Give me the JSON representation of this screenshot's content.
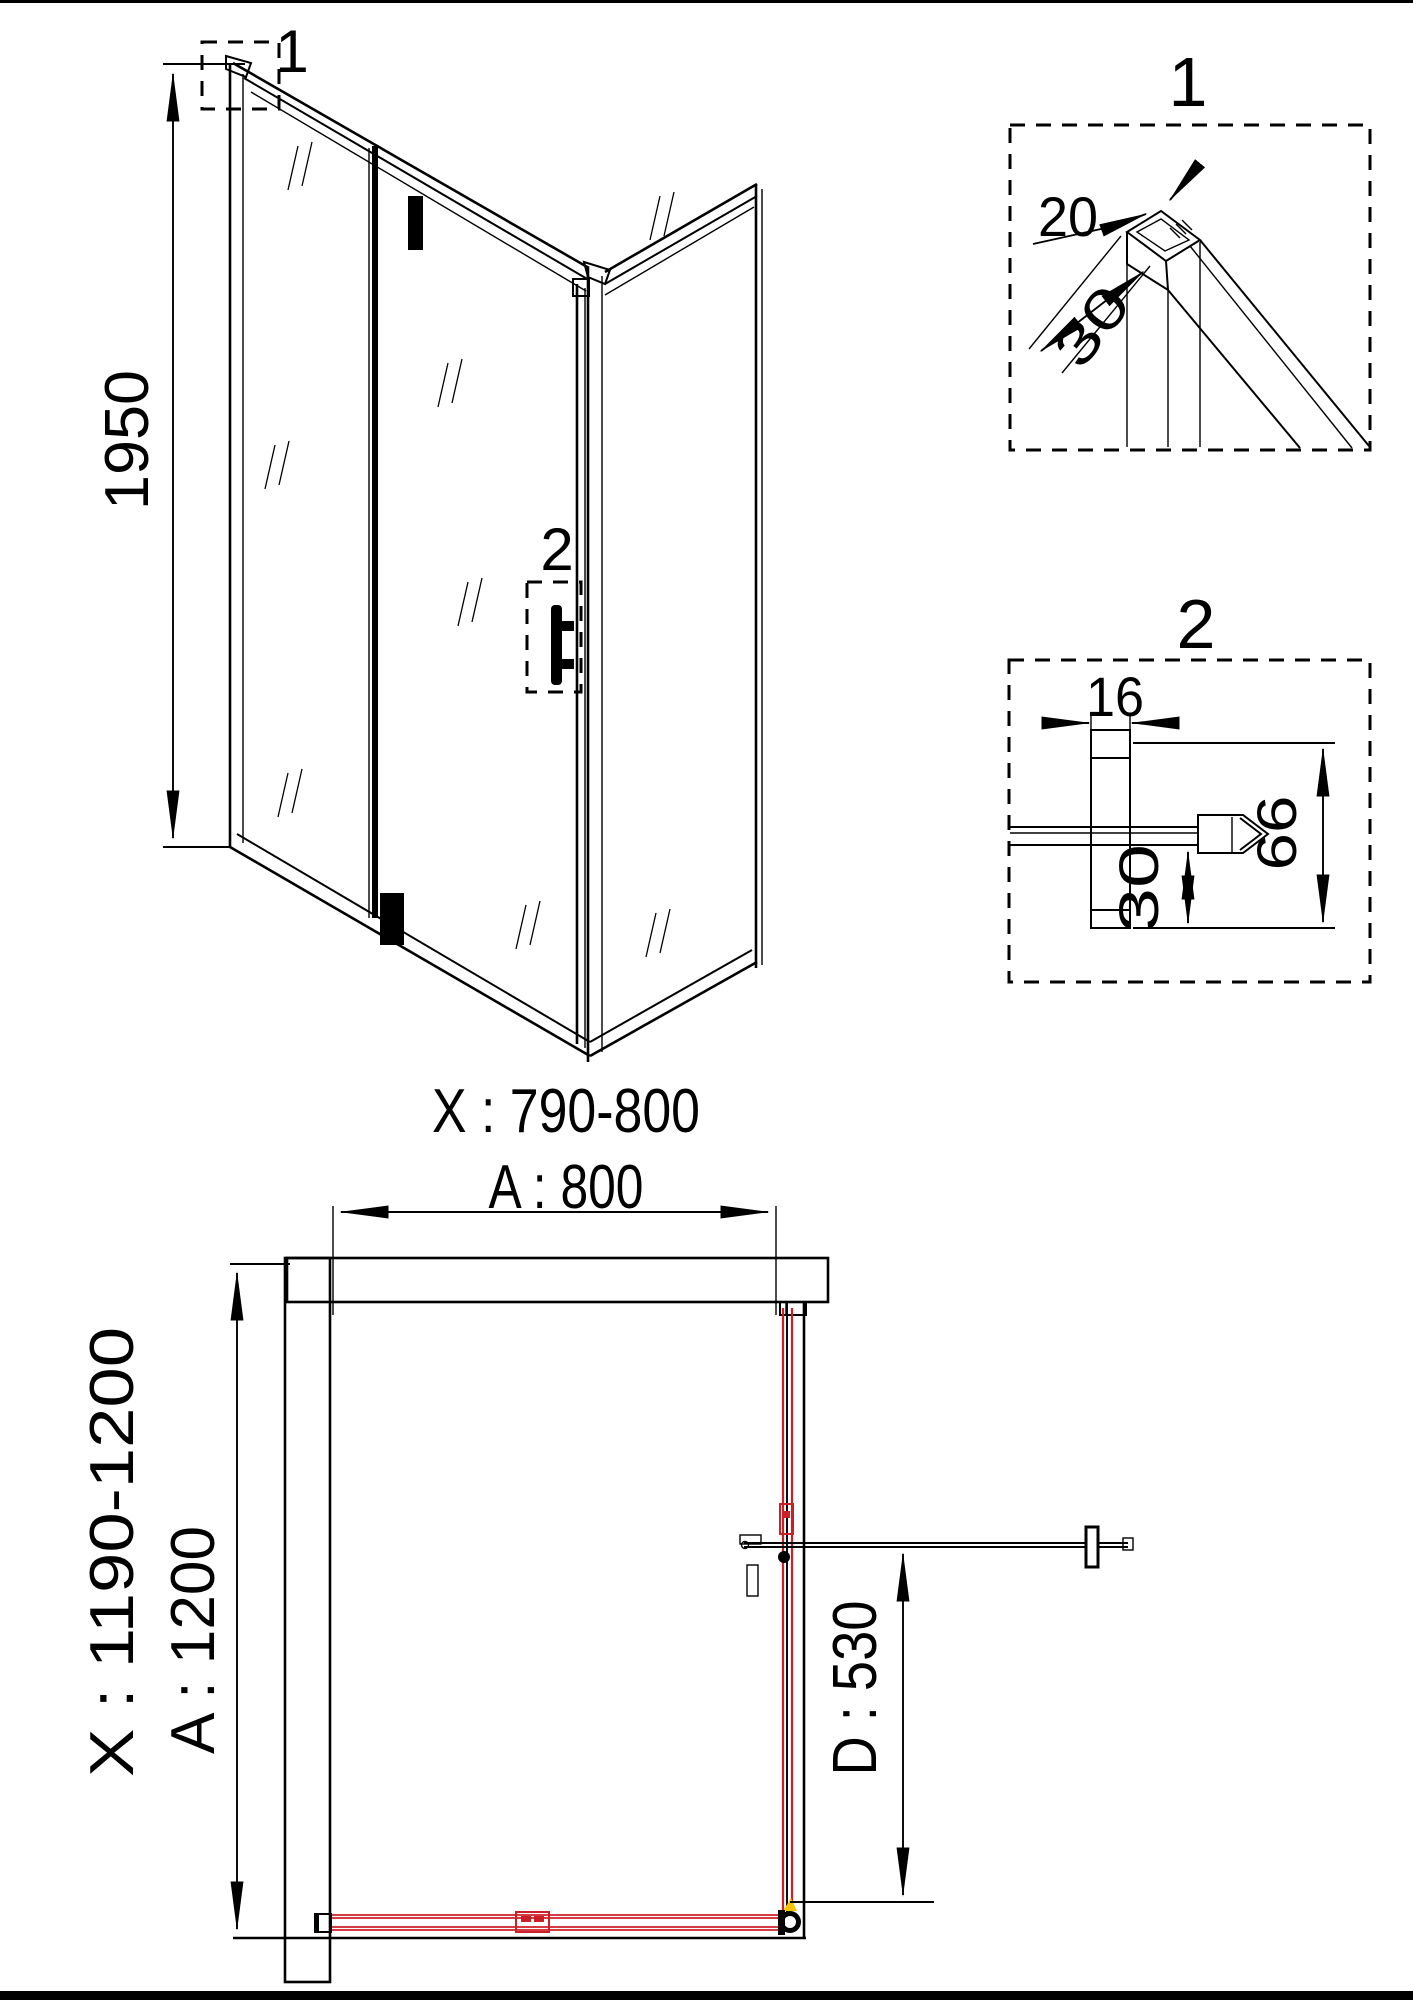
{
  "view3d": {
    "height_dim": "1950",
    "callout_corner": "1",
    "callout_handle": "2"
  },
  "detail1": {
    "label": "1",
    "dim_profile_width": "20",
    "dim_profile_depth": "30"
  },
  "detail2": {
    "label": "2",
    "dim_post_width": "16",
    "dim_below_glass": "30",
    "dim_total_height": "66"
  },
  "plan": {
    "width_adjust_range": "X : 790-800",
    "width_nominal": "A : 800",
    "depth_adjust_range": "X : 1190-1200",
    "depth_nominal": "A : 1200",
    "door_width": "D : 530"
  },
  "colors": {
    "line": "#000000",
    "red": "#CB2027",
    "yellow": "#F5C400"
  }
}
